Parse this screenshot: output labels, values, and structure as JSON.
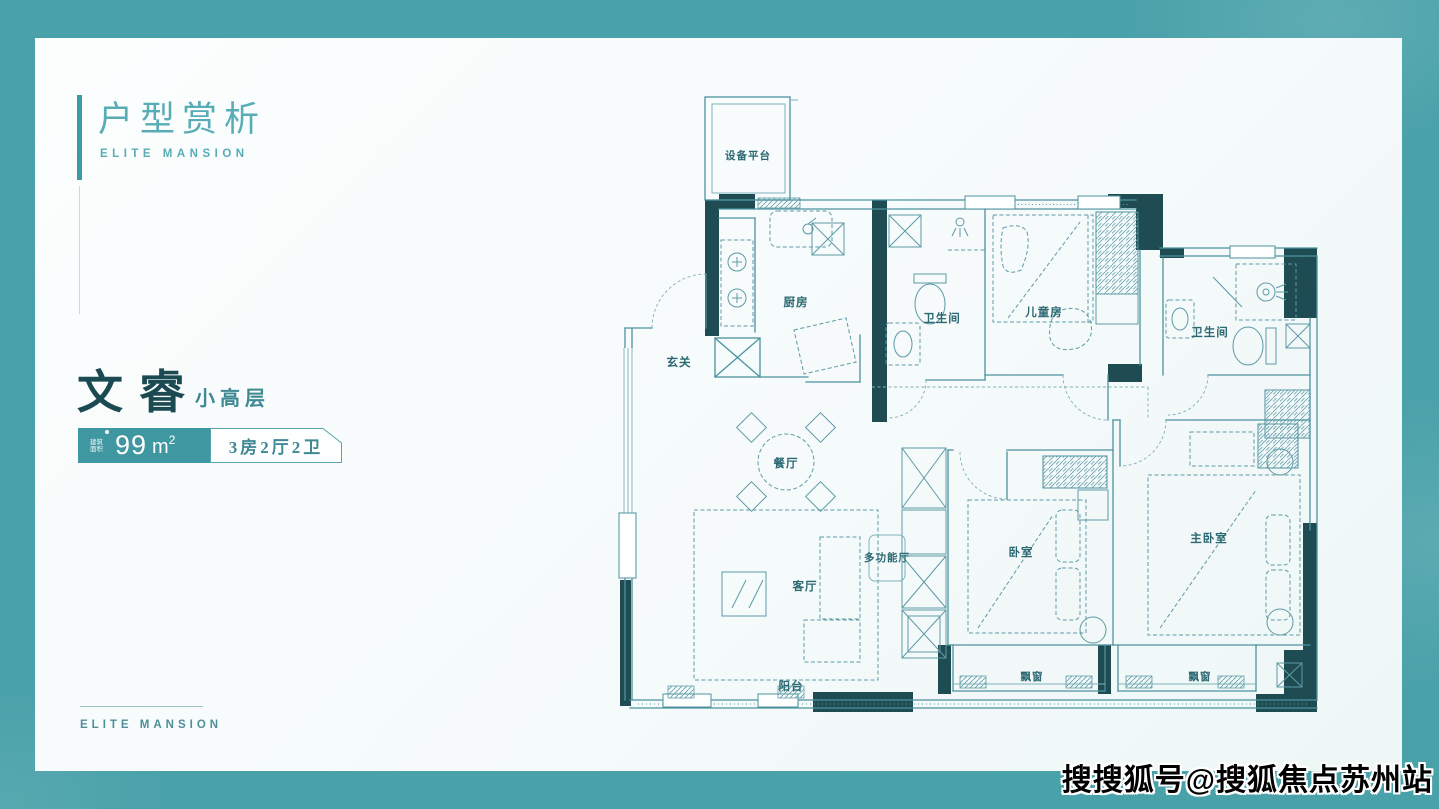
{
  "colors": {
    "page_border": "#49a1a9",
    "card_bg": "#f8fbfb",
    "accent": "#3f98a2",
    "title_teal": "#58acb5",
    "dark_teal_text": "#1c4a52",
    "wall_dark": "#1f4b52",
    "plan_line": "#4d929f",
    "badge_bg": "#3f97a1",
    "watermark_text": "#000000"
  },
  "header": {
    "title": "户型赏析",
    "subtitle": "ELITE MANSION"
  },
  "unit": {
    "name": "文睿",
    "grade": "小高层",
    "area_tag_line1": "建筑",
    "area_tag_line2": "面积",
    "area_value": "99",
    "area_unit": "m",
    "area_exponent": "2",
    "layout_spec": "3房2厅2卫"
  },
  "footer": {
    "brand": "ELITE MANSION"
  },
  "watermark": {
    "text": "搜搜狐号@搜狐焦点苏州站"
  },
  "floorplan": {
    "rooms": [
      {
        "label": "设备平台"
      },
      {
        "label": "厨房"
      },
      {
        "label": "卫生间"
      },
      {
        "label": "儿童房"
      },
      {
        "label": "卫生间"
      },
      {
        "label": "玄关"
      },
      {
        "label": "餐厅"
      },
      {
        "label": "多功能厅"
      },
      {
        "label": "客厅"
      },
      {
        "label": "卧室"
      },
      {
        "label": "主卧室"
      },
      {
        "label": "阳台"
      },
      {
        "label": "飘窗"
      },
      {
        "label": "飘窗"
      }
    ]
  }
}
